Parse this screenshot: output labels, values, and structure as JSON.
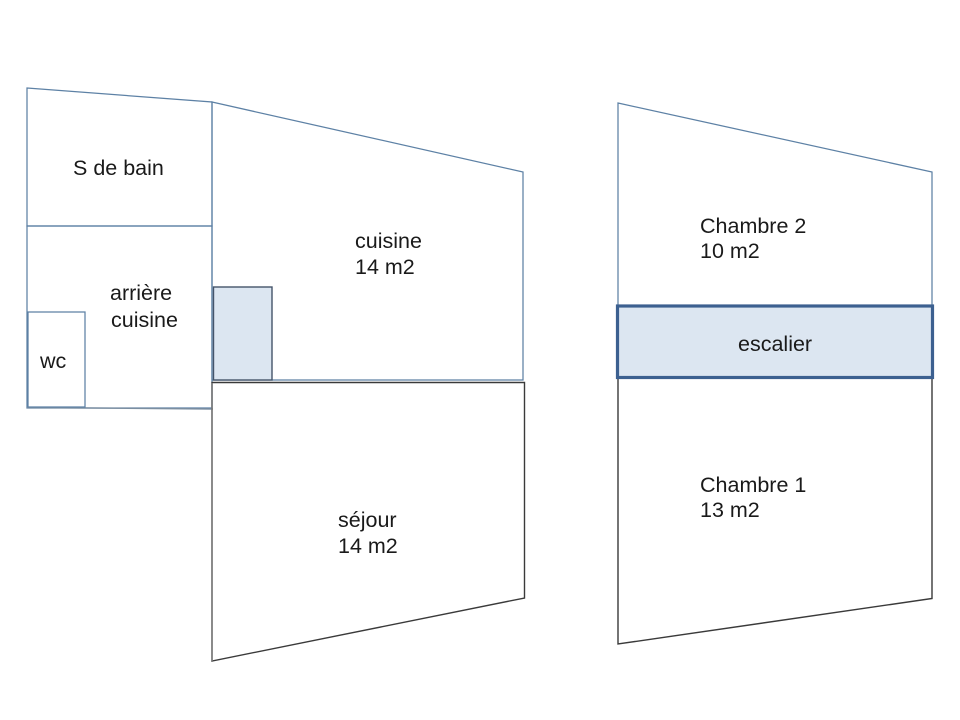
{
  "slide": {
    "background": "#ffffff"
  },
  "colors": {
    "slide_bg": "#ffffff",
    "wall_blue": "#5d81a5",
    "wall_dark": "#3a3a3a",
    "wall_gray": "#7f7f7f",
    "wall_muted": "#7b8ea1",
    "stairs_fill": "#dce6f1",
    "stairs_border": "#3c6090",
    "closet_fill": "#dce6f1",
    "closet_border": "#44546a",
    "text_color": "#1a1a1a"
  },
  "ground_floor": {
    "rooms": {
      "s_de_bain": {
        "label": "S de bain"
      },
      "arriere_cuisine": {
        "line1": "arrière",
        "line2": "cuisine"
      },
      "wc": {
        "label": "wc"
      },
      "cuisine": {
        "label": "cuisine",
        "area": "14 m2"
      },
      "sejour": {
        "label": "séjour",
        "area": "14 m2"
      }
    }
  },
  "upper_floor": {
    "rooms": {
      "chambre_2": {
        "label": "Chambre 2",
        "area": "10 m2"
      },
      "escalier": {
        "label": "escalier"
      },
      "chambre_1": {
        "label": "Chambre 1",
        "area": "13 m2"
      }
    }
  }
}
